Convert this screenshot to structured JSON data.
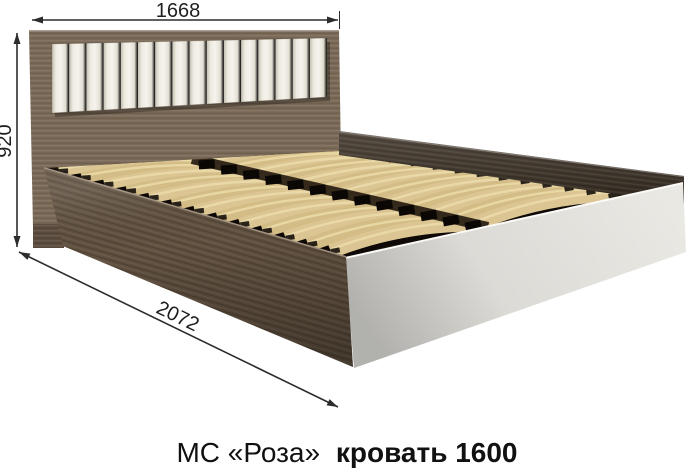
{
  "diagram": {
    "dimensions": {
      "width": "1668",
      "height": "920",
      "length": "2072"
    },
    "caption": {
      "series": "МС «Роза»",
      "product": "кровать 1600"
    },
    "colors": {
      "headboard_wood": "#7b6a58",
      "near_rail_wood": "#60503f",
      "far_rail_wood": "#372c20",
      "deck_background": "#1a130c",
      "cushion": "#efece3",
      "slats": "#d7c08b",
      "footboard": "#e9e8e3",
      "dimension_lines": "#2c2c2c",
      "background": "#ffffff"
    }
  }
}
